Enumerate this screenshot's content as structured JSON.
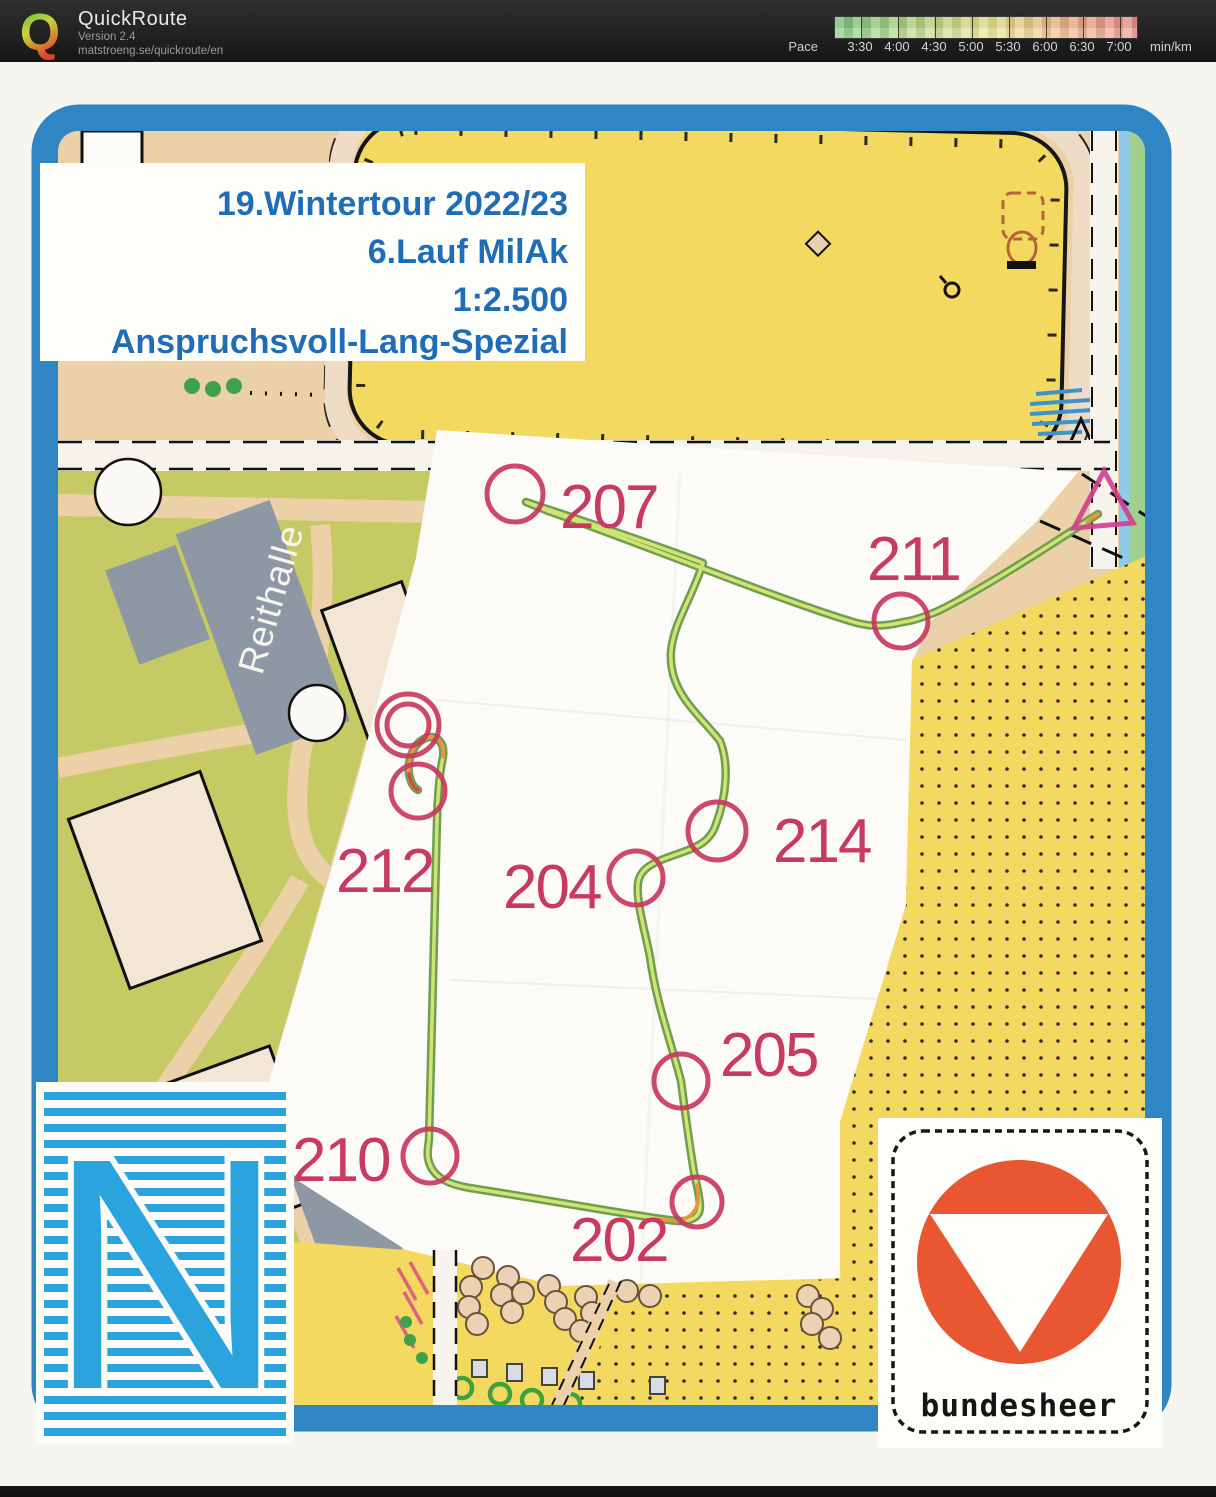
{
  "header": {
    "app_name": "QuickRoute",
    "version_line": "Version 2.4",
    "url_line": "matstroeng.se/quickroute/en",
    "logo_letter": "Q",
    "pace_scale": {
      "label": "Pace",
      "unit": "min/km",
      "ticks": [
        "3:30",
        "4:00",
        "4:30",
        "5:00",
        "5:30",
        "6:00",
        "6:30",
        "7:00"
      ],
      "gradient_colors": [
        "#7cc47c",
        "#a9d383",
        "#cdd987",
        "#e9e18c",
        "#ecc687",
        "#eda586",
        "#ee8e8d"
      ]
    }
  },
  "map": {
    "title_lines": [
      "19.Wintertour 2022/23",
      "6.Lauf MilAk",
      "1:2.500",
      "Anspruchsvoll-Lang-Spezial"
    ],
    "labels": {
      "building": "Reithalle",
      "army_logo_text": "bundesheer",
      "region_logo_letter": "N"
    },
    "course": {
      "controls": [
        {
          "label": "207"
        },
        {
          "label": "211"
        },
        {
          "label": "214"
        },
        {
          "label": "204"
        },
        {
          "label": "205"
        },
        {
          "label": "202"
        },
        {
          "label": "210"
        },
        {
          "label": "212"
        }
      ]
    },
    "colors": {
      "frame_blue": "#2f86c3",
      "course_overlay": "#c83a5e",
      "start_triangle": "#d0408c",
      "route_outer_green": "#6f9e53",
      "route_inner_yellow": "#cfe472",
      "route_slow_orange": "#e8953e",
      "route_slowest_red": "#d14e3c",
      "field_yellow": "#f3d95f",
      "vegetation_olive": "#c6ca64",
      "building_gray": "#8e97a4",
      "road_tan": "#ecd0a8",
      "title_blue": "#1e6db6",
      "n_logo_blue": "#2ba3dc",
      "bundesheer_red": "#e85632"
    }
  }
}
